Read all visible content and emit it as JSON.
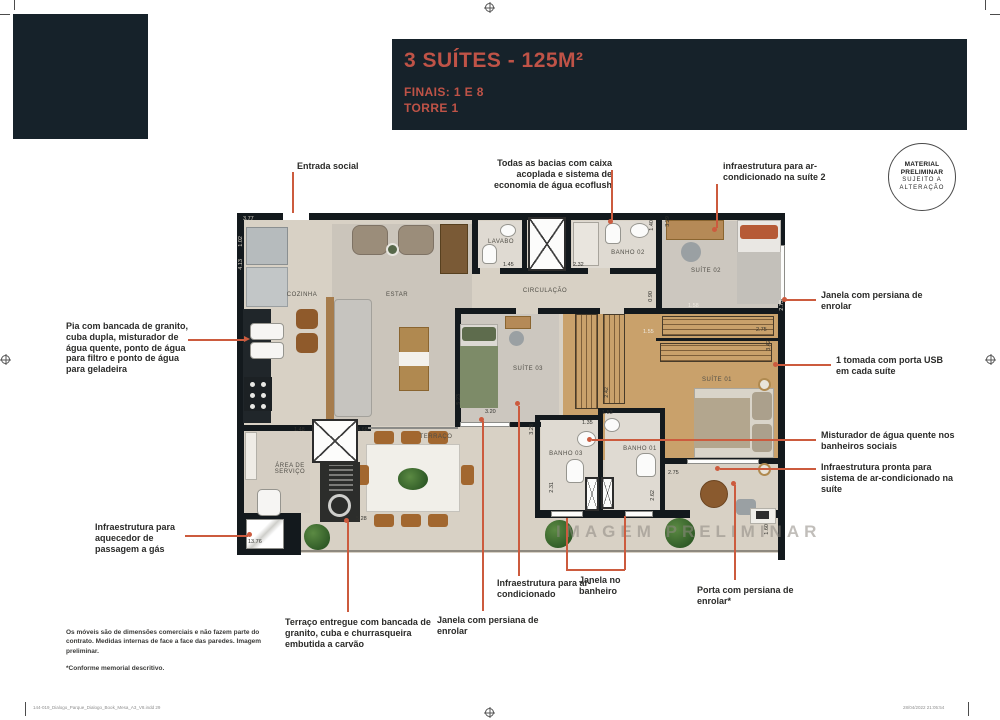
{
  "header": {
    "title": "3 SUÍTES - 125M²",
    "subtitle1": "FINAIS: 1 E 8",
    "subtitle2": "TORRE 1"
  },
  "badge": {
    "line1": "MATERIAL",
    "line2": "PRELIMINAR",
    "line3": "SUJEITO A",
    "line4": "ALTERAÇÃO"
  },
  "colors": {
    "dark_block": "#16222a",
    "accent_text": "#bf5347",
    "leader_line": "#cc5b3e"
  },
  "callouts": {
    "entrada_social": "Entrada social",
    "bacias": "Todas as bacias com caixa acoplada e sistema de economia de água ecoflush",
    "infra_suite2": "infraestrutura para ar-condicionado na suíte 2",
    "janela_persiana_direita": "Janela com persiana de enrolar",
    "tomada_usb": "1 tomada com porta USB em cada suíte",
    "misturador": "Misturador de água quente nos banheiros sociais",
    "infra_pronta": "Infraestrutura pronta para sistema de ar-condicionado na suíte",
    "porta_persiana": "Porta com persiana de enrolar*",
    "janela_banheiro": "Janela no banheiro",
    "infra_ar": "Infraestrutura para ar-condicionado",
    "janela_persiana_baixo": "Janela com persiana de enrolar",
    "terraco_entregue": "Terraço entregue com bancada de granito, cuba e churrasqueira embutida a carvão",
    "infra_aquecedor": "Infraestrutura para aquecedor de passagem a gás",
    "pia": "Pia com bancada de granito, cuba dupla, misturador de água quente, ponto de água para filtro e ponto de água para geladeira"
  },
  "plan": {
    "rooms": {
      "cozinha": "COZINHA",
      "estar": "ESTAR",
      "lavabo": "LAVABO",
      "banho02": "BANHO 02",
      "suite02": "SUÍTE 02",
      "circulacao": "CIRCULAÇÃO",
      "suite03": "SUÍTE 03",
      "suite01": "SUÍTE 01",
      "banho03": "BANHO 03",
      "banho01": "BANHO 01",
      "terraco": "TERRAÇO",
      "area_servico": "ÁREA DE SERVIÇO"
    },
    "watermark": "IMAGEM PRELIMINAR",
    "measurements": {
      "m377": "3.77",
      "m102": "1.02",
      "m413": "4.13",
      "m523": "5.23",
      "m148": "1.48",
      "m468": "4.68",
      "m528": "5.28",
      "m1376": "13.76",
      "m145": "1.45",
      "m232": "2.32",
      "m140": "1.40",
      "m329": "3.29",
      "m090": "0.90",
      "m155": "1.55",
      "m158": "1.58",
      "m273": "2.73",
      "m275a": "2.75",
      "m342": "3.42",
      "m320": "3.20",
      "m328": "3.28",
      "m135": "1.35",
      "m153": "1.53",
      "m242": "2.42",
      "m231": "2.31",
      "m262": "2.62",
      "m275b": "2.75",
      "m160": "1.60"
    }
  },
  "footnotes": {
    "disclaimer": "Os móveis são de dimensões comerciais e não fazem parte do contrato. Medidas internas de face a face das paredes. Imagem preliminar.",
    "memorial": "*Conforme memorial descritivo."
  },
  "footer": {
    "filename": "144-019_Dialogo_Parque_Dialogo_Book_Mesa_A3_V8.indd   29",
    "timestamp": "28/04/2022   21:05:54"
  }
}
